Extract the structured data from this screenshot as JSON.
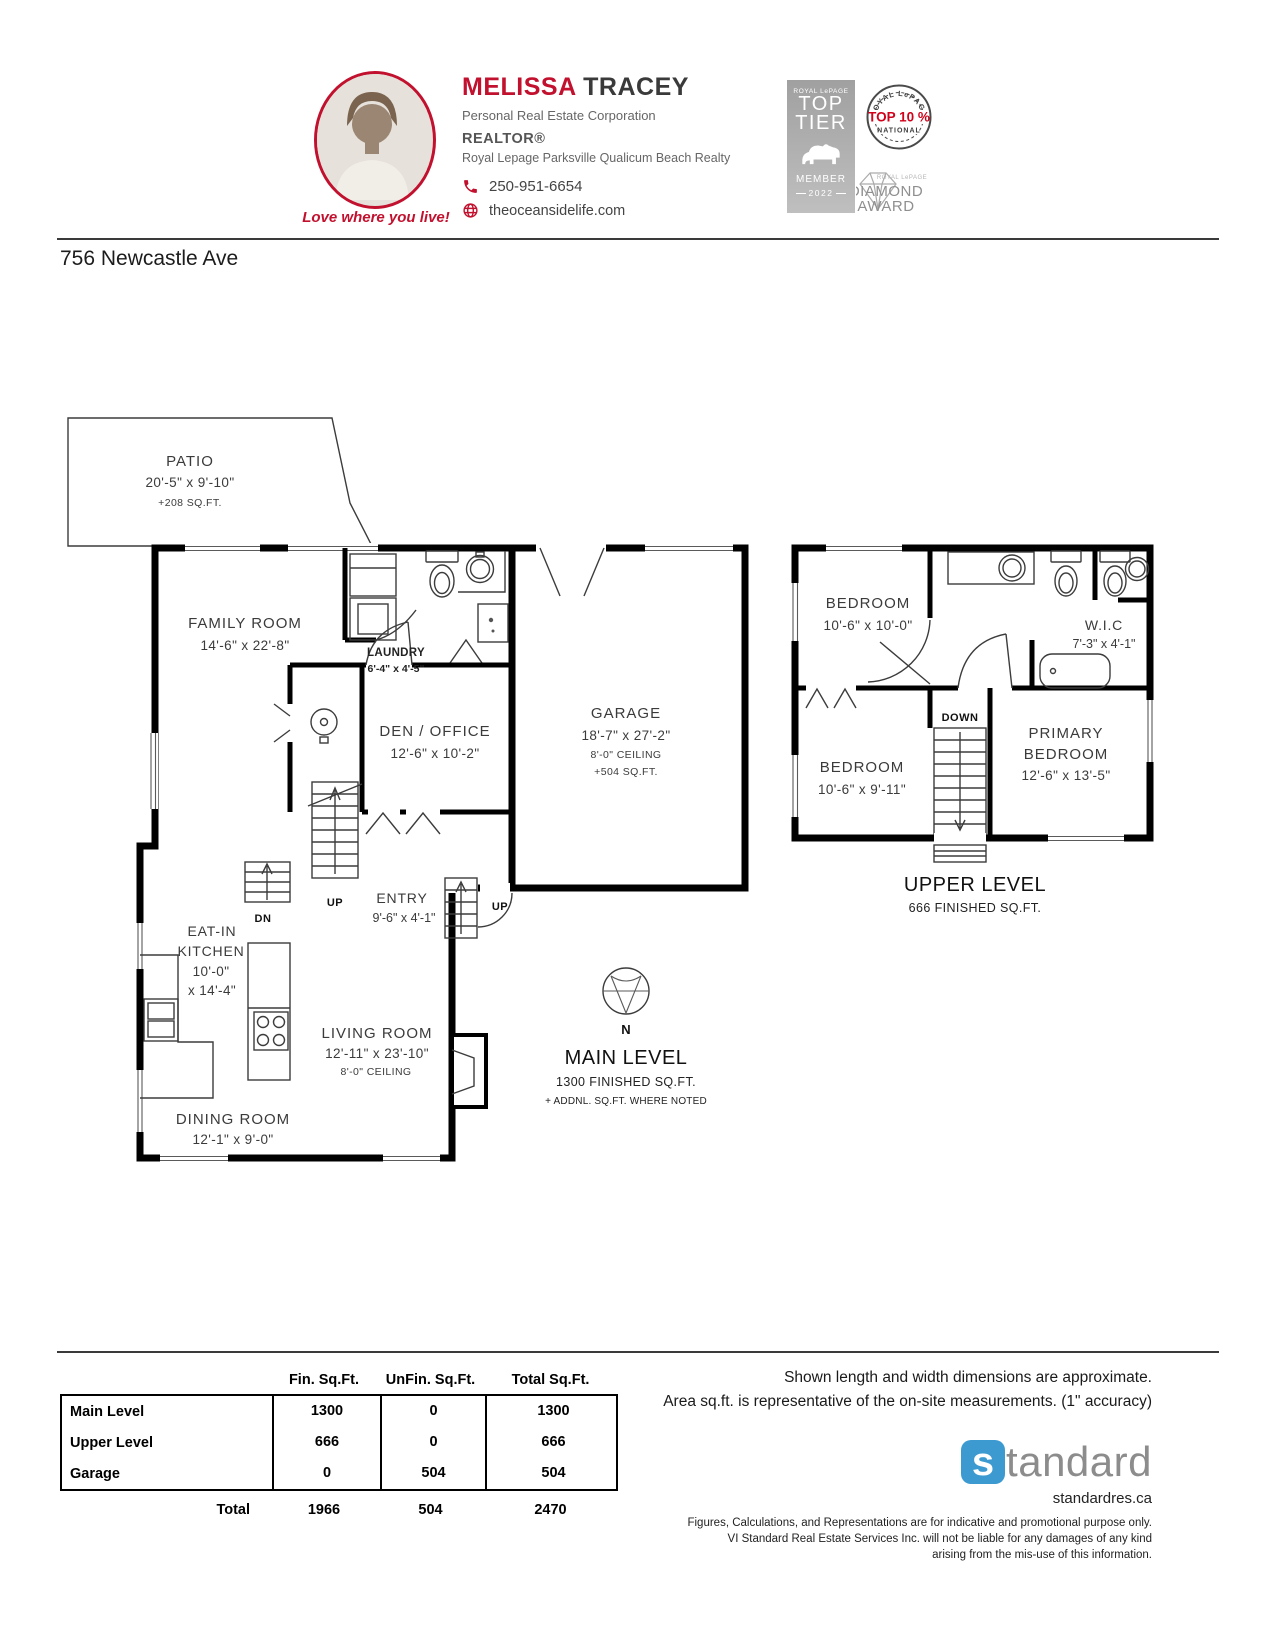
{
  "agent": {
    "first_name": "MELISSA",
    "last_name": "TRACEY",
    "title": "Personal Real Estate Corporation",
    "designation": "REALTOR®",
    "brokerage": "Royal Lepage Parksville Qualicum Beach Realty",
    "phone": "250-951-6654",
    "website": "theoceansidelife.com",
    "tagline": "Love where you live!"
  },
  "badges": {
    "top_tier": {
      "brand": "ROYAL LePAGE",
      "word1": "TOP",
      "word2": "TIER",
      "member": "MEMBER",
      "year": "2022"
    },
    "top_ten": {
      "brand": "ROYAL LePAGE",
      "label": "TOP 10 %",
      "sub": "NATIONAL"
    },
    "diamond": {
      "brand": "ROYAL LePAGE",
      "word1": "DIAMOND",
      "word2": "AWARD"
    }
  },
  "address": "756 Newcastle Ave",
  "main_level": {
    "title": "MAIN LEVEL",
    "area": "1300 FINISHED SQ.FT.",
    "note": "+ ADDNL. SQ.FT. WHERE NOTED",
    "compass_label": "N",
    "patio": {
      "name": "PATIO",
      "dims": "20'-5\" x 9'-10\"",
      "area": "+208 SQ.FT."
    },
    "family_room": {
      "name": "FAMILY ROOM",
      "dims": "14'-6\" x 22'-8\""
    },
    "laundry": {
      "name": "LAUNDRY",
      "dims": "6'-4\" x 4'-5\""
    },
    "den_office": {
      "name": "DEN / OFFICE",
      "dims": "12'-6\" x 10'-2\""
    },
    "garage": {
      "name": "GARAGE",
      "dims": "18'-7\" x 27'-2\"",
      "ceiling": "8'-0\" CEILING",
      "area": "+504 SQ.FT."
    },
    "entry": {
      "name": "ENTRY",
      "dims": "9'-6\" x 4'-1\""
    },
    "kitchen": {
      "name_line1": "EAT-IN",
      "name_line2": "KITCHEN",
      "dims_line1": "10'-0\"",
      "dims_line2": "x 14'-4\""
    },
    "living_room": {
      "name": "LIVING ROOM",
      "dims": "12'-11\" x 23'-10\"",
      "ceiling": "8'-0\" CEILING"
    },
    "dining_room": {
      "name": "DINING ROOM",
      "dims": "12'-1\" x 9'-0\""
    },
    "stair_up_label": "UP",
    "stair_dn_label": "DN",
    "stair_up2_label": "UP"
  },
  "upper_level": {
    "title": "UPPER LEVEL",
    "area": "666 FINISHED SQ.FT.",
    "bedroom1": {
      "name": "BEDROOM",
      "dims": "10'-6\" x 10'-0\""
    },
    "bedroom2": {
      "name": "BEDROOM",
      "dims": "10'-6\" x 9'-11\""
    },
    "wic": {
      "name": "W.I.C",
      "dims": "7'-3\" x 4'-1\""
    },
    "primary_bedroom": {
      "name_line1": "PRIMARY",
      "name_line2": "BEDROOM",
      "dims": "12'-6\" x 13'-5\""
    },
    "stair_down_label": "DOWN"
  },
  "table": {
    "col_headers": [
      "Fin. Sq.Ft.",
      "UnFin. Sq.Ft.",
      "Total Sq.Ft."
    ],
    "rows": [
      {
        "label": "Main Level",
        "fin": "1300",
        "unfin": "0",
        "total": "1300"
      },
      {
        "label": "Upper Level",
        "fin": "666",
        "unfin": "0",
        "total": "666"
      },
      {
        "label": "Garage",
        "fin": "0",
        "unfin": "504",
        "total": "504"
      }
    ],
    "total_row": {
      "label": "Total",
      "fin": "1966",
      "unfin": "504",
      "total": "2470"
    }
  },
  "notes": {
    "line1": "Shown length and width dimensions are approximate.",
    "line2": "Area sq.ft. is representative of the on-site measurements. (1\" accuracy)"
  },
  "footer": {
    "logo_first_letter": "s",
    "logo_rest": "tandard",
    "website": "standardres.ca",
    "disclaimer_line1": "Figures, Calculations, and Representations are for indicative and promotional purpose only.",
    "disclaimer_line2": "VI Standard Real Estate Services Inc. will not be liable for any damages of any kind",
    "disclaimer_line3": "arising from the mis-use of this information."
  },
  "colors": {
    "accent_red": "#c2112e",
    "top10_red": "#d0021b",
    "logo_blue": "#3d9ad1",
    "logo_gray": "#8c8c8c"
  }
}
